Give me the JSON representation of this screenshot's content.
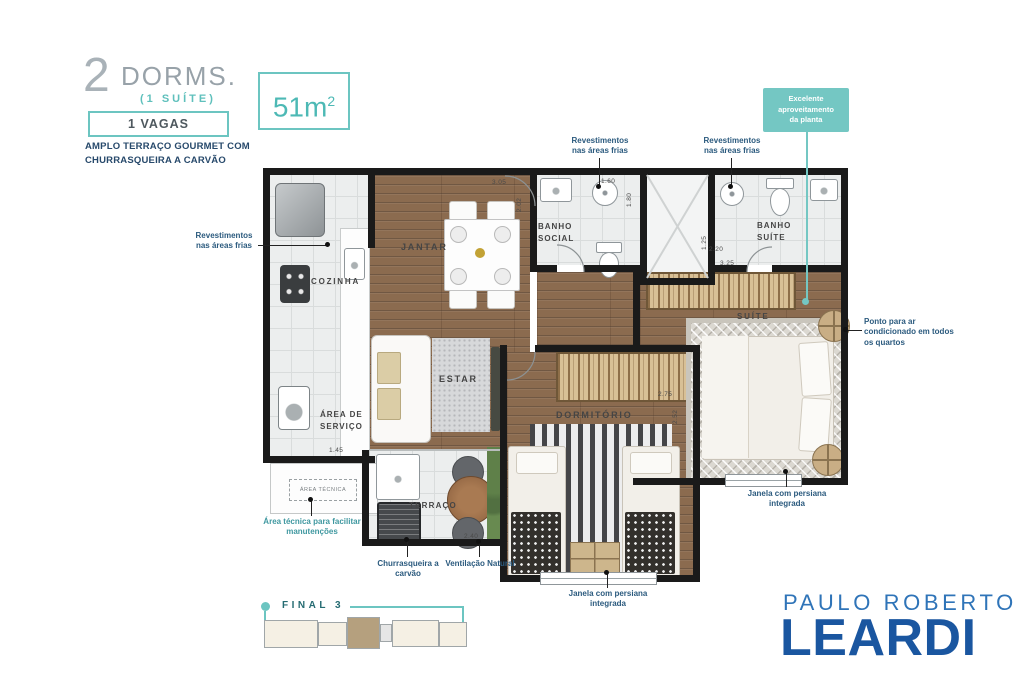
{
  "header": {
    "dorms_number": "2",
    "dorms_label": "DORMS.",
    "suite_note": "(1 SUÍTE)",
    "vagas": "1 VAGAS",
    "tagline_line1": "AMPLO TERRAÇO GOURMET COM",
    "tagline_line2": "CHURRASQUEIRA A CARVÃO",
    "area_value": "51m",
    "area_sup": "2"
  },
  "callout": {
    "text": "Excelente aproveitamento da planta"
  },
  "rooms": {
    "cozinha": "COZINHA",
    "area_servico": "ÁREA DE SERVIÇO",
    "area_tecnica": "ÁREA TÉCNICA",
    "jantar": "JANTAR",
    "estar": "ESTAR",
    "terraco": "TERRAÇO",
    "banho_social": "BANHO SOCIAL",
    "banho_suite": "BANHO SUÍTE",
    "suite": "SUÍTE",
    "dormitorio": "DORMITÓRIO"
  },
  "dimensions": {
    "jantar_w": "3.05",
    "jantar_h": "2.02",
    "banho_social_w": "1.60",
    "banho_social_h": "1.80",
    "banho_suite_w": "2.20",
    "banho_suite_h": "1.25",
    "suite_closet_w": "3.25",
    "dormitorio_w": "2.75",
    "dormitorio_h": "2.52",
    "area_servico_w": "1.45",
    "terraco_w": "2.40"
  },
  "annotations": {
    "revestimentos": "Revestimentos nas áreas frias",
    "ponto_ar": "Ponto para ar condicionado em todos os quartos",
    "janela": "Janela com persiana integrada",
    "churrasqueira": "Churrasqueira a carvão",
    "ventilacao": "Ventilação Natural",
    "area_tecnica_note": "Área técnica para facilitar manutenções"
  },
  "final_plan": {
    "label": "FINAL 3"
  },
  "logo": {
    "line1": "PAULO ROBERTO",
    "line2": "LEARDI"
  },
  "colors": {
    "teal": "#6cc5c1",
    "badge_teal": "#74c7c3",
    "navy": "#27496b",
    "annotation_blue": "#2b5a7e",
    "logo_light_blue": "#2f74b8",
    "logo_blue": "#1a56a0",
    "wall": "#1a1a1a",
    "wood": "#8b6b4f"
  }
}
